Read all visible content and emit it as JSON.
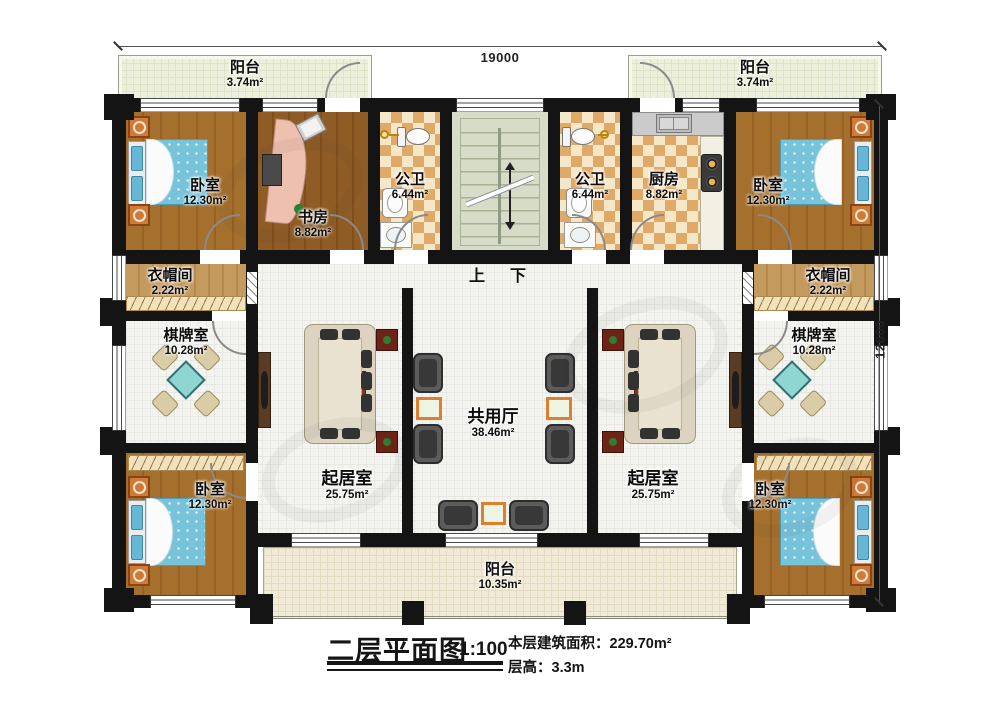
{
  "dimensions": {
    "top_width": "19000",
    "right_height": "12600"
  },
  "stairs": {
    "up": "上",
    "down": "下"
  },
  "rooms": {
    "balcony_top_left": {
      "name": "阳台",
      "area": "3.74m²"
    },
    "balcony_top_right": {
      "name": "阳台",
      "area": "3.74m²"
    },
    "bedroom_top_left": {
      "name": "卧室",
      "area": "12.30m²"
    },
    "study": {
      "name": "书房",
      "area": "8.82m²"
    },
    "bath_left": {
      "name": "公卫",
      "area": "6.44m²"
    },
    "bath_right": {
      "name": "公卫",
      "area": "6.44m²"
    },
    "kitchen": {
      "name": "厨房",
      "area": "8.82m²"
    },
    "bedroom_top_right": {
      "name": "卧室",
      "area": "12.30m²"
    },
    "cloak_left": {
      "name": "衣帽间",
      "area": "2.22m²"
    },
    "cloak_right": {
      "name": "衣帽间",
      "area": "2.22m²"
    },
    "games_left": {
      "name": "棋牌室",
      "area": "10.28m²"
    },
    "games_right": {
      "name": "棋牌室",
      "area": "10.28m²"
    },
    "living_left": {
      "name": "起居室",
      "area": "25.75m²"
    },
    "living_right": {
      "name": "起居室",
      "area": "25.75m²"
    },
    "shared_hall": {
      "name": "共用厅",
      "area": "38.46m²"
    },
    "bedroom_bottom_left": {
      "name": "卧室",
      "area": "12.30m²"
    },
    "bedroom_bottom_right": {
      "name": "卧室",
      "area": "12.30m²"
    },
    "balcony_bottom": {
      "name": "阳台",
      "area": "10.35m²"
    }
  },
  "title_block": {
    "title": "二层平面图",
    "scale": "1:100",
    "build_area": "本层建筑面积：229.70m²",
    "floor_height": "层高：3.3m"
  }
}
